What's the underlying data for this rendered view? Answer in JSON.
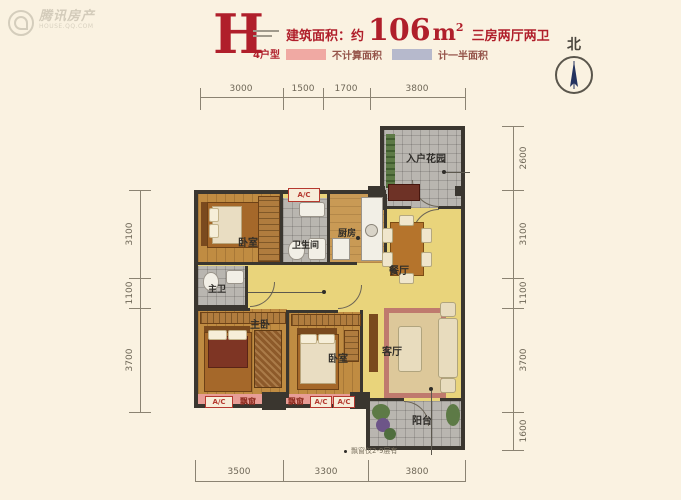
{
  "watermark": {
    "brand": "腾讯房产",
    "site": "HOUSE.QQ.COM"
  },
  "header": {
    "type_letter": "H",
    "type_label": "4户型",
    "area_prefix": "建筑面积：约",
    "area_value": "106",
    "area_unit": "m",
    "area_sup": "2",
    "layout_desc": "三房两厅两卫"
  },
  "legend": {
    "no_area": {
      "label": "不计算面积",
      "color": "#f0a9a3"
    },
    "half_area": {
      "label": "计一半面积",
      "color": "#b6b9cc"
    }
  },
  "compass": {
    "label": "北"
  },
  "dimensions": {
    "top": [
      "3000",
      "1500",
      "1700",
      "3800"
    ],
    "bottom": [
      "3500",
      "3300",
      "3800"
    ],
    "left": [
      "3100",
      "1100",
      "3700"
    ],
    "right": [
      "2600",
      "3100",
      "1100",
      "3700",
      "1600"
    ]
  },
  "rooms": {
    "entry_garden": "入户花园",
    "bedroom1": "卧室",
    "bathroom": "卫生间",
    "kitchen": "厨房",
    "dining": "餐厅",
    "master_bath": "主卫",
    "master_bedroom": "主卧",
    "bedroom2": "卧室",
    "living": "客厅",
    "balcony": "阳台"
  },
  "annotations": {
    "ac": "A/C",
    "bay_window": "飘窗",
    "floor_note": "飘窗仅2-9层有"
  }
}
